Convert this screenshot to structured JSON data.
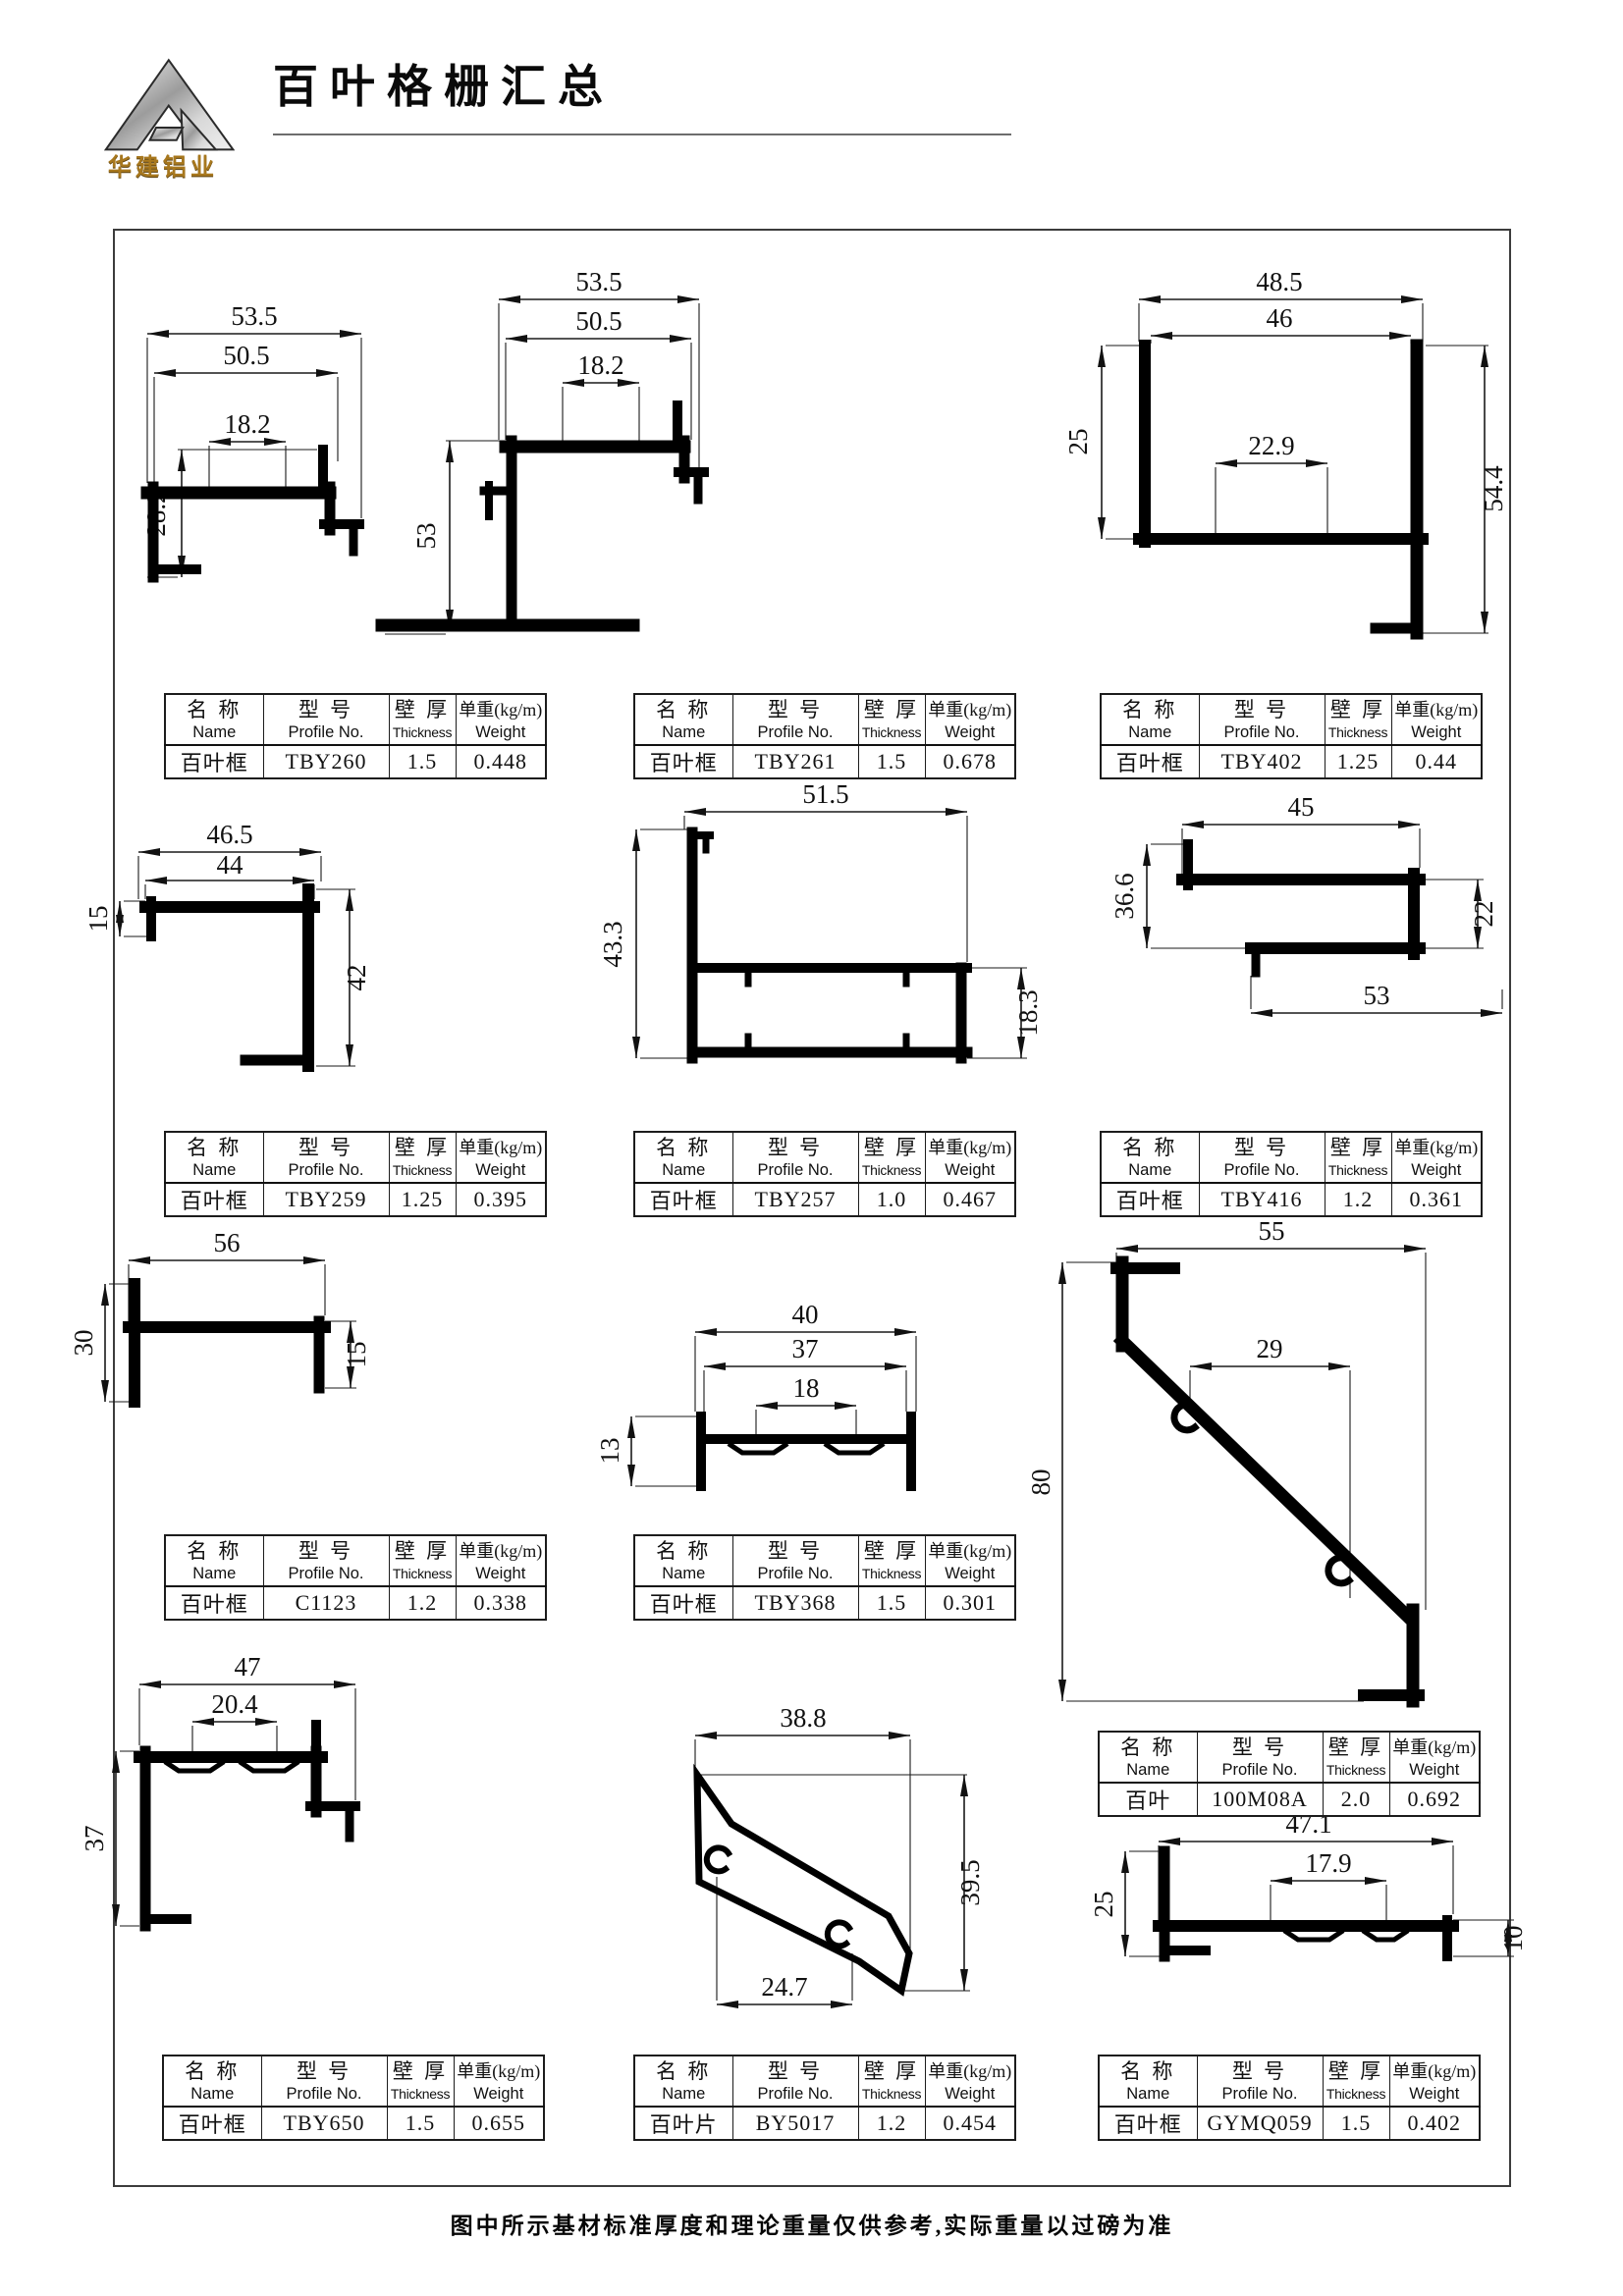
{
  "header": {
    "logo_text": "华建铝业",
    "title": "百叶格栅汇总"
  },
  "table_header": {
    "name_cn": "名 称",
    "name_en": "Name",
    "model_cn": "型 号",
    "model_en": "Profile No.",
    "thickness_cn": "壁 厚",
    "thickness_en": "Thickness",
    "weight_cn": "单重(kg/m)",
    "weight_en": "Weight"
  },
  "profiles": [
    {
      "name": "百叶框",
      "model": "TBY260",
      "thickness": "1.5",
      "weight": "0.448",
      "dims": {
        "d1": "53.5",
        "d2": "50.5",
        "d3": "18.2",
        "d4": "28.2"
      }
    },
    {
      "name": "百叶框",
      "model": "TBY261",
      "thickness": "1.5",
      "weight": "0.678",
      "dims": {
        "d1": "53.5",
        "d2": "50.5",
        "d3": "18.2",
        "d4": "53"
      }
    },
    {
      "name": "百叶框",
      "model": "TBY402",
      "thickness": "1.25",
      "weight": "0.44",
      "dims": {
        "d1": "48.5",
        "d2": "46",
        "d3": "22.9",
        "d4": "25",
        "d5": "54.4"
      }
    },
    {
      "name": "百叶框",
      "model": "TBY259",
      "thickness": "1.25",
      "weight": "0.395",
      "dims": {
        "d1": "46.5",
        "d2": "44",
        "d3": "15",
        "d4": "42"
      }
    },
    {
      "name": "百叶框",
      "model": "TBY257",
      "thickness": "1.0",
      "weight": "0.467",
      "dims": {
        "d1": "51.5",
        "d2": "43.3",
        "d3": "18.3"
      }
    },
    {
      "name": "百叶框",
      "model": "TBY416",
      "thickness": "1.2",
      "weight": "0.361",
      "dims": {
        "d1": "45",
        "d2": "36.6",
        "d3": "22",
        "d4": "53"
      }
    },
    {
      "name": "百叶框",
      "model": "C1123",
      "thickness": "1.2",
      "weight": "0.338",
      "dims": {
        "d1": "56",
        "d2": "30",
        "d3": "15"
      }
    },
    {
      "name": "百叶框",
      "model": "TBY368",
      "thickness": "1.5",
      "weight": "0.301",
      "dims": {
        "d1": "40",
        "d2": "37",
        "d3": "18",
        "d4": "13"
      }
    },
    {
      "name": "百叶",
      "model": "100M08A",
      "thickness": "2.0",
      "weight": "0.692",
      "dims": {
        "d1": "55",
        "d2": "29",
        "d3": "80"
      }
    },
    {
      "name": "百叶框",
      "model": "TBY650",
      "thickness": "1.5",
      "weight": "0.655",
      "dims": {
        "d1": "47",
        "d2": "20.4",
        "d3": "37"
      }
    },
    {
      "name": "百叶片",
      "model": "BY5017",
      "thickness": "1.2",
      "weight": "0.454",
      "dims": {
        "d1": "38.8",
        "d2": "39.5",
        "d3": "24.7"
      }
    },
    {
      "name": "百叶框",
      "model": "GYMQ059",
      "thickness": "1.5",
      "weight": "0.402",
      "dims": {
        "d1": "47.1",
        "d2": "17.9",
        "d3": "25",
        "d4": "10"
      }
    }
  ],
  "footer": {
    "note": "图中所示基材标准厚度和理论重量仅供参考,实际重量以过磅为准"
  }
}
